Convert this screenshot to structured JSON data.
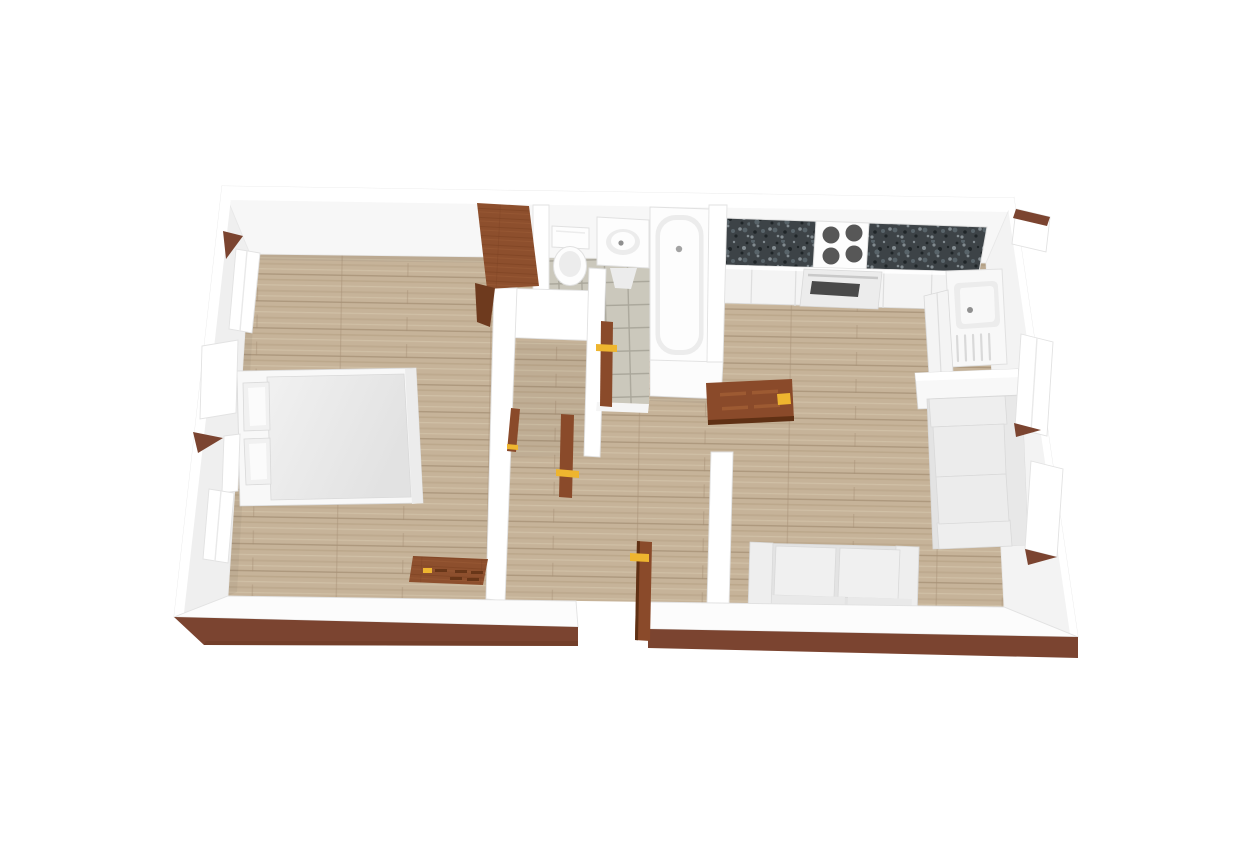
{
  "scene": {
    "type": "3d-floor-plan-render",
    "view": "dollhouse top-down perspective",
    "background": "#ffffff",
    "apartment": {
      "shape": "rectangular",
      "exterior_base_trim": "dark wood",
      "cutaway_wall": "south (bottom) wall cut low"
    }
  },
  "rooms": [
    {
      "id": "bedroom",
      "position": "left",
      "floor": "wood planks",
      "furniture": [
        "double-bed",
        "wardrobe",
        "dresser"
      ]
    },
    {
      "id": "closet-nook",
      "position": "center",
      "floor": "wood planks",
      "furniture": []
    },
    {
      "id": "bathroom",
      "position": "top-center",
      "floor": "gray tile",
      "fixtures": [
        "toilet",
        "vanity-sink",
        "bathtub"
      ]
    },
    {
      "id": "kitchen",
      "position": "top-right",
      "floor": "wood planks",
      "fixtures": [
        "granite-l-counter",
        "cooktop-4-burners",
        "oven",
        "kitchen-sink-drainboard"
      ]
    },
    {
      "id": "living-room",
      "position": "right",
      "floor": "wood planks",
      "furniture": [
        "loveseat",
        "sofa",
        "console-cabinet"
      ]
    },
    {
      "id": "hallway",
      "position": "center-bottom",
      "floor": "wood planks",
      "furniture": []
    }
  ],
  "doors": [
    {
      "id": "entry-door",
      "state": "open",
      "material": "wood",
      "handle": "gold"
    },
    {
      "id": "bathroom-door",
      "state": "open",
      "material": "wood",
      "handle": "gold"
    },
    {
      "id": "closet-door",
      "state": "open",
      "material": "wood",
      "handle": "gold"
    },
    {
      "id": "bedroom-door",
      "state": "open",
      "material": "wood",
      "handle": "gold"
    },
    {
      "id": "living-room-door",
      "state": "open-flat-against-wall",
      "material": "wood",
      "handle": "gold"
    }
  ],
  "windows": [
    {
      "wall": "left",
      "count": 3,
      "style": "white casement, some sashes open"
    },
    {
      "wall": "right",
      "count": 3,
      "style": "white casement with wood sills"
    }
  ],
  "colors": {
    "background": "#ffffff",
    "wall_white": "#ffffff",
    "wall_face_top": "#f7f7f7",
    "wall_face_left": "#efefef",
    "wall_face_right": "#f3f3f3",
    "wall_band": "#fcfcfc",
    "floor_base": "#c6b399",
    "floor_streak_dark": "#b19d80",
    "floor_streak_light": "#d6c8ae",
    "floor_plank_line": "#a69176",
    "tile_base": "#cbc8bc",
    "tile_grout": "#a9a69a",
    "trim_brown": "#7b4430",
    "trim_brown_dark": "#64361f",
    "door_wood": "#8a4a2a",
    "door_wood_dark": "#5f3014",
    "door_panel": "#a25e35",
    "handle_gold": "#eeb52f",
    "granite_base": "#3d4347",
    "granite_speck_light": "#828b90",
    "granite_speck_mid": "#59646a",
    "granite_speck_dark": "#1f2528",
    "burner": "#575757",
    "oven_glass": "#4a4a4a",
    "cabinet_face": "#f4f4f4",
    "fixture_white": "#fdfdfd",
    "fixture_shade": "#ececec",
    "wardrobe_wood": "#8d4f2d",
    "wardrobe_grain_dark": "#7a3f21",
    "wardrobe_grain_light": "#a05f38",
    "wardrobe_side": "#6e3a1e",
    "sofa_base": "#e3e3e3",
    "sofa_cushion": "#eeeeee",
    "mattress_light": "#f1f1f1",
    "mattress_dark": "#e2e2e2",
    "bed_frame": "#f8f8f8"
  }
}
